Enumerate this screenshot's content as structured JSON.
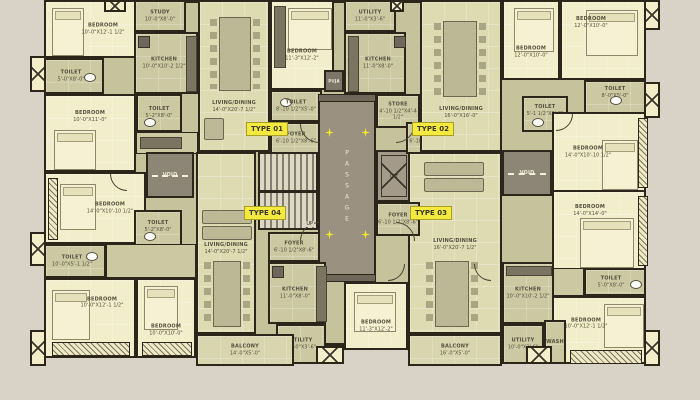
{
  "plan": {
    "unit_tags": [
      {
        "label": "TYPE 01"
      },
      {
        "label": "TYPE 02"
      },
      {
        "label": "TYPE 03"
      },
      {
        "label": "TYPE 04"
      }
    ],
    "core": {
      "passage_label": "PASSAGE",
      "lift_label": "LIFT",
      "stair_label": "UP"
    },
    "rooms": [
      {
        "name": "BEDROOM",
        "dims": "10'-0\"X12'-1 1/2\""
      },
      {
        "name": "TOILET",
        "dims": "5'-0\"X8'-0\""
      },
      {
        "name": "BEDROOM",
        "dims": "10'-0\"X11'-0\""
      },
      {
        "name": "TOILET",
        "dims": "5'-2\"X8'-0\""
      },
      {
        "name": "STUDY",
        "dims": "10'-0\"X8'-0\""
      },
      {
        "name": "KITCHEN",
        "dims": "10'-0\"X10'-2 1/2\""
      },
      {
        "name": "LIVING/DINING",
        "dims": "14'-0\"X20'-7 1/2\""
      },
      {
        "name": "BEDROOM",
        "dims": "11'-3\"X12'-2\""
      },
      {
        "name": "TOILET",
        "dims": "8'-10 1/2\"X5'-0\""
      },
      {
        "name": "FOYER",
        "dims": "6'-10 1/2\"X8'-6\""
      },
      {
        "name": "UTILITY",
        "dims": "11'-0\"X3'-6\""
      },
      {
        "name": "KITCHEN",
        "dims": "11'-0\"X8'-0\""
      },
      {
        "name": "STORE",
        "dims": "4'-10 1/2\"X4'-4 1/2\""
      },
      {
        "name": "FOYER",
        "dims": "6'-10 1/2\"X8'-6 1/2\""
      },
      {
        "name": "LIVING/DINING",
        "dims": "16'-0\"X16'-0\""
      },
      {
        "name": "BEDROOM",
        "dims": "12'-0\"X10'-0\""
      },
      {
        "name": "BEDROOM",
        "dims": "12'-0\"X10'-0\""
      },
      {
        "name": "TOILET",
        "dims": "8'-0\"X5'-0\""
      },
      {
        "name": "TOILET",
        "dims": "5'-1 1/2\"X8'-0\""
      },
      {
        "name": "BEDROOM",
        "dims": "14'-0\"X10'-10 1/2\""
      },
      {
        "name": "BEDROOM",
        "dims": "14'-0\"X10'-10 1/2\""
      },
      {
        "name": "TOILET",
        "dims": "10'-0\"X5'-1 1/2\""
      },
      {
        "name": "TOILET",
        "dims": "5'-2\"X8'-0\""
      },
      {
        "name": "BEDROOM",
        "dims": "10'-0\"X12'-1 1/2\""
      },
      {
        "name": "BEDROOM",
        "dims": "10'-0\"X10'-0\""
      },
      {
        "name": "LIVING/DINING",
        "dims": "14'-0\"X20'-7 1/2\""
      },
      {
        "name": "FOYER",
        "dims": "6'-10 1/2\"X8'-6\""
      },
      {
        "name": "KITCHEN",
        "dims": "11'-0\"X8'-0\""
      },
      {
        "name": "UTILITY",
        "dims": "11'-0\"X3'-6\""
      },
      {
        "name": "BALCONY",
        "dims": "14'-0\"X5'-0\""
      },
      {
        "name": "BEDROOM",
        "dims": "11'-3\"X12'-2\""
      },
      {
        "name": "LIVING/DINING",
        "dims": "16'-0\"X20'-7 1/2\""
      },
      {
        "name": "FOYER",
        "dims": "6'-10 1/2\"X8'-6\""
      },
      {
        "name": "KITCHEN",
        "dims": "10'-0\"X10'-2 1/2\""
      },
      {
        "name": "UTILITY",
        "dims": "10'-0\"X3'-6\""
      },
      {
        "name": "WASH",
        "dims": ""
      },
      {
        "name": "BALCONY",
        "dims": "16'-0\"X5'-0\""
      },
      {
        "name": "BEDROOM",
        "dims": "14'-0\"X14'-0\""
      },
      {
        "name": "TOILET",
        "dims": "5'-0\"X8'-0\""
      },
      {
        "name": "BEDROOM",
        "dims": "10'-0\"X12'-1 1/2\""
      },
      {
        "name": "VOID",
        "dims": ""
      },
      {
        "name": "VOID",
        "dims": ""
      },
      {
        "name": "PUJA",
        "dims": ""
      }
    ],
    "colors": {
      "background": "#d8d3c6",
      "wall": "#2c2519",
      "floor_olive": "#ccc8a2",
      "floor_cream": "#f2edca",
      "floor_pale": "#dedbb2",
      "core_gray": "#9a9181",
      "tag_yellow": "#f4ea3f",
      "arrow_yellow": "#f2e829"
    }
  }
}
